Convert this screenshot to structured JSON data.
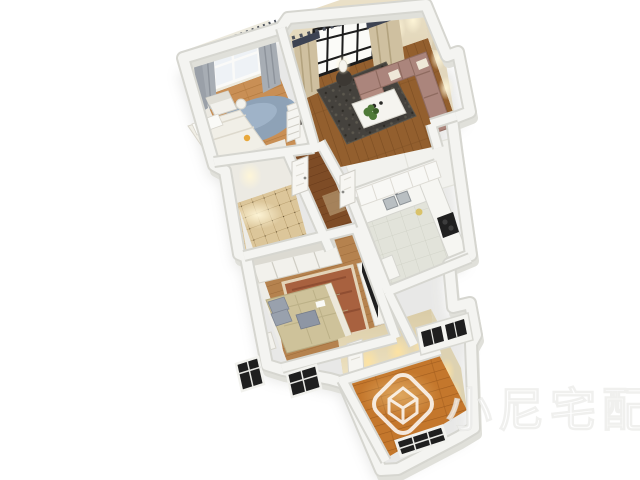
{
  "watermark": {
    "text": "小尼宅配",
    "logo": "cube-logo",
    "color": "#ffffff"
  },
  "scene": {
    "type": "3d-floorplan-render",
    "view": "isometric-aerial",
    "background": "#ffffff"
  },
  "palette": {
    "wallTop": "#f4f4f1",
    "wallEdge": "#d6d6d0",
    "wallFace": "#e4e4de",
    "beigeWall": "#e9dfc8",
    "woodBedroom": "#c98f55",
    "woodBedroomGap": "#b0783e",
    "woodLiving": "#935f2e",
    "woodLivingGap": "#7c4d22",
    "woodHall": "#7e4c26",
    "woodHallGap": "#683a1a",
    "woodMaster": "#b5824e",
    "woodMasterGap": "#9c6b3a",
    "woodEmpty": "#c4772c",
    "woodEmptyGap": "#a25d1e",
    "tileBath": "#dcc69a",
    "tileBathLine": "#b89e6e",
    "kitchenFloor": "#e2e3da",
    "kitchenFloorLine": "#cdd0c4",
    "rugBlue": "#8ba3bd",
    "rugDark": "#45423d",
    "rugOriental": "#a8613f",
    "rugOrientalBorder": "#e3d3b8",
    "sofa": "#ab857c",
    "sofaLight": "#b28b80",
    "bedWhite": "#f1efe7",
    "bedKhaki": "#cec29a",
    "pillowGray": "#99a1ad",
    "curtainGray": "#a7adb4",
    "curtainBeige": "#cfc0a0",
    "valanceDark": "#3d4352",
    "glassDark": "#1f1f1f",
    "glassLight": "#eef2f6",
    "glow": "#ffe8ad",
    "plant": "#4f7a38"
  },
  "rooms": [
    {
      "id": "bedroom-small",
      "label": "small bedroom",
      "floor": "oak wood",
      "furniture": [
        "double-bed",
        "armchair",
        "round-blue-rug",
        "tv-cabinet",
        "window",
        "gray-curtains"
      ]
    },
    {
      "id": "living-room",
      "label": "living room",
      "floor": "walnut wood",
      "furniture": [
        "corner-sofa",
        "coffee-table",
        "dark-area-rug",
        "floor-lamp",
        "plant",
        "bookcase",
        "floor-to-ceiling-window",
        "beige-curtains"
      ]
    },
    {
      "id": "bathroom",
      "label": "bathroom",
      "floor": "beige tile",
      "furniture": [
        "ceiling-spotlight"
      ]
    },
    {
      "id": "hallway",
      "label": "hallway",
      "floor": "dark wood",
      "furniture": [
        "white-door",
        "white-door"
      ]
    },
    {
      "id": "kitchen",
      "label": "kitchen",
      "floor": "pale tile",
      "furniture": [
        "l-shaped-counter",
        "double-sink",
        "cooktop",
        "upper-cabinets",
        "island-cabinet",
        "paned-window-block"
      ]
    },
    {
      "id": "master-bedroom",
      "label": "master bedroom",
      "floor": "wood",
      "furniture": [
        "sliding-wardrobe",
        "double-bed",
        "patterned-pillows",
        "oriental-rug",
        "tv",
        "tv-console",
        "bench",
        "dark-windows"
      ]
    },
    {
      "id": "empty-room",
      "label": "empty room",
      "floor": "orange wood",
      "furniture": [
        "dark-paned-window",
        "white-door",
        "wall-spotlights"
      ]
    }
  ]
}
